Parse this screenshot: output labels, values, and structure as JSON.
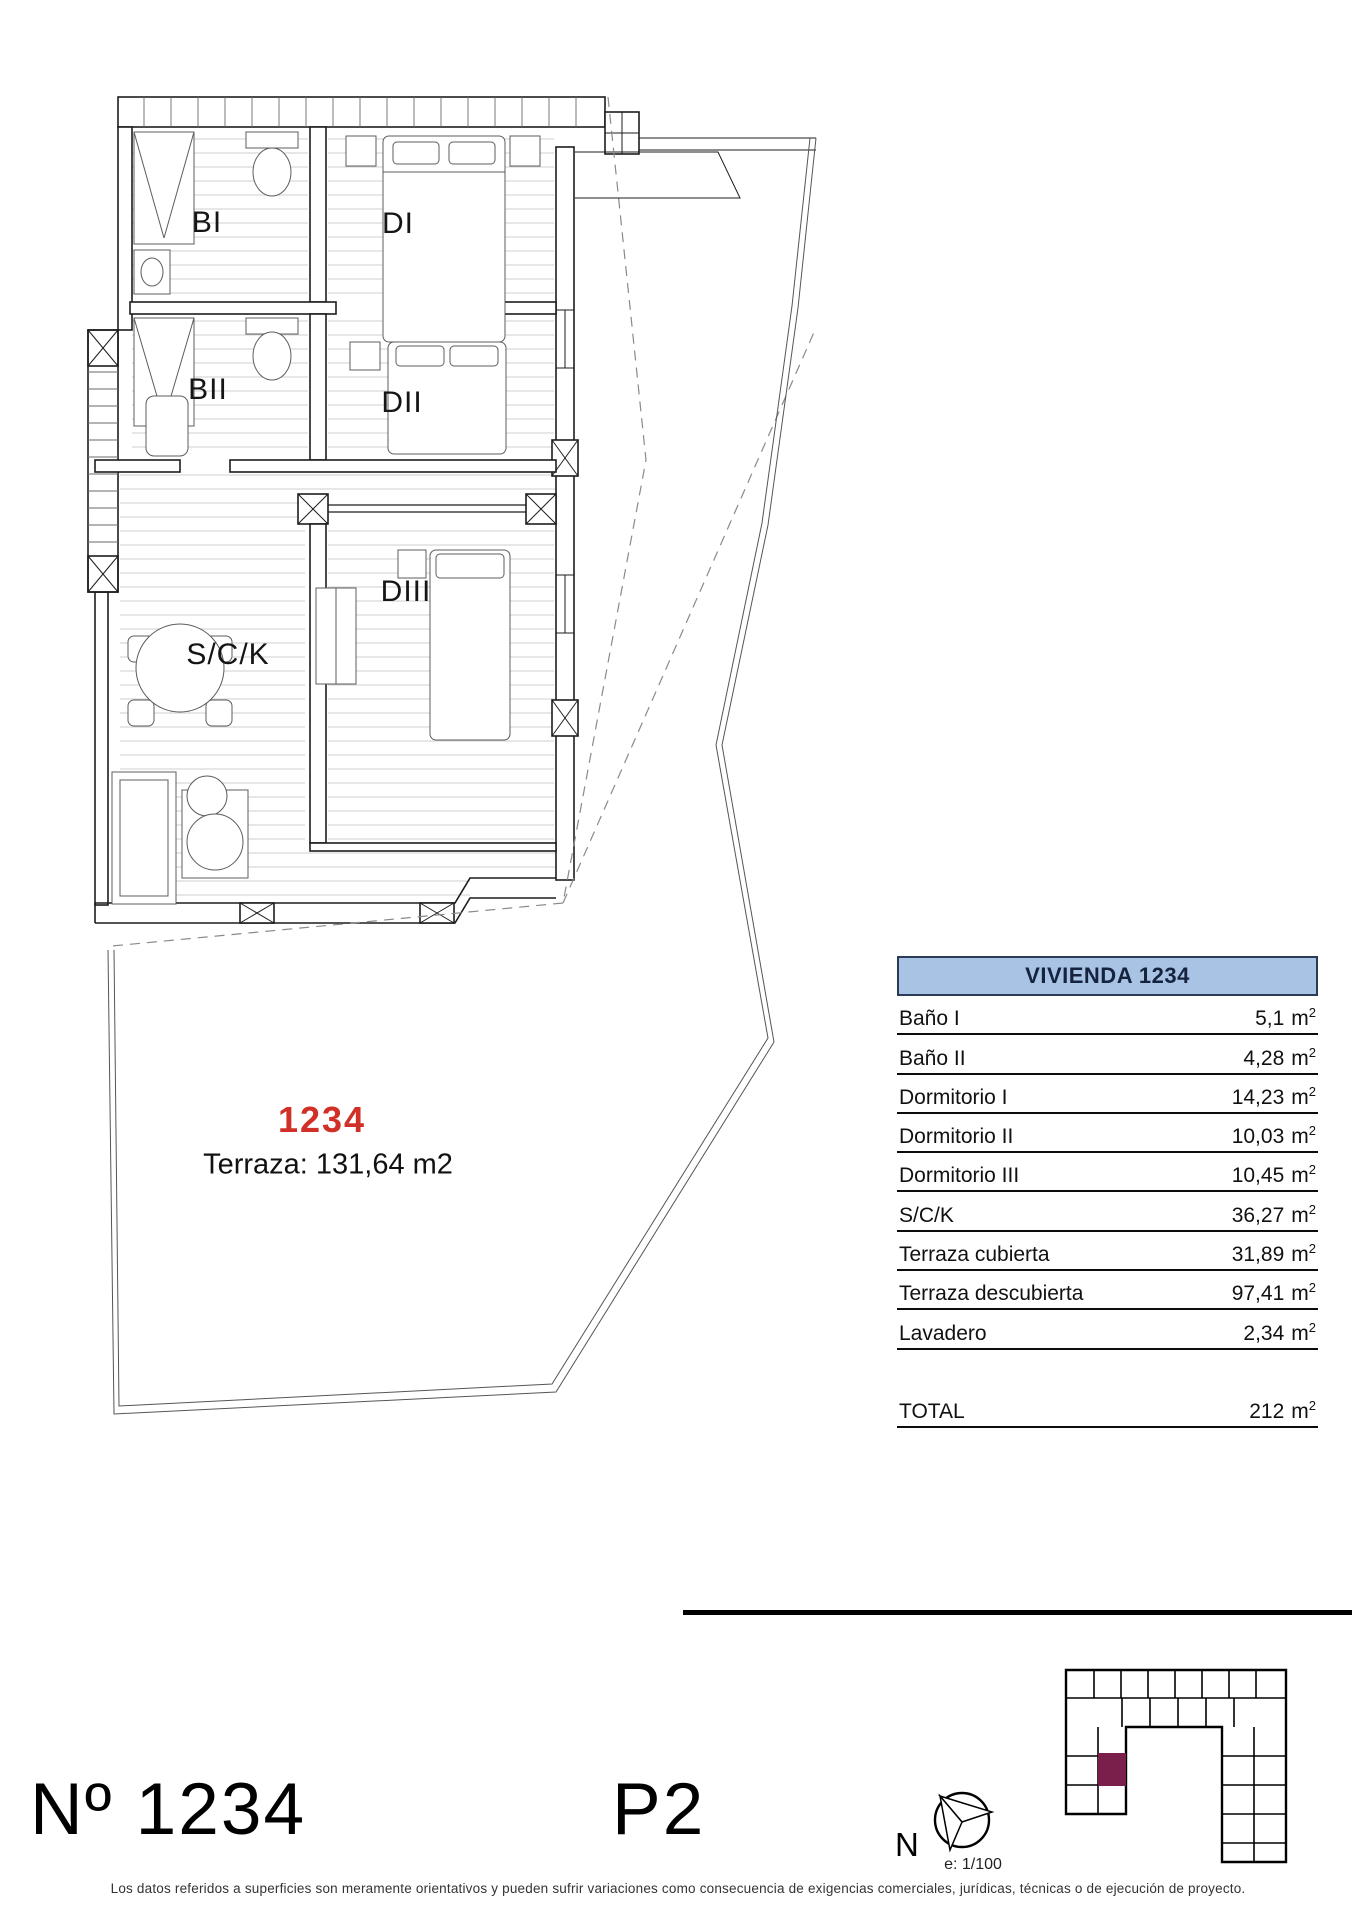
{
  "unit": {
    "number_red": "1234",
    "terrace_note": "Terraza: 131,64 m2",
    "sheet_title": "Nº 1234",
    "floor_label": "P2"
  },
  "rooms": {
    "bath1": "BI",
    "bed1": "DI",
    "bath2": "BII",
    "bed2": "DII",
    "bed3": "DIII",
    "living_kitchen": "S/C/K"
  },
  "table": {
    "header": "VIVIENDA 1234",
    "unit_m": "m",
    "unit_sup": "2",
    "rows": [
      {
        "label": "Baño I",
        "value": "5,1"
      },
      {
        "label": "Baño II",
        "value": "4,28"
      },
      {
        "label": "Dormitorio I",
        "value": "14,23"
      },
      {
        "label": "Dormitorio II",
        "value": "10,03"
      },
      {
        "label": "Dormitorio III",
        "value": "10,45"
      },
      {
        "label": "S/C/K",
        "value": "36,27"
      },
      {
        "label": "Terraza cubierta",
        "value": "31,89"
      },
      {
        "label": "Terraza descubierta",
        "value": "97,41"
      },
      {
        "label": "Lavadero",
        "value": "2,34"
      }
    ],
    "total": {
      "label": "TOTAL",
      "value": "212"
    }
  },
  "compass": {
    "north": "N",
    "scale": "e: 1/100"
  },
  "footer": {
    "disclaimer": "Los datos referidos a superficies son meramente orientativos y pueden sufrir variaciones como consecuencia de exigencias comerciales, jurídicas, técnicas o de ejecución de proyecto."
  },
  "colors": {
    "accent_red": "#d03027",
    "site_highlight": "#7a1f4b",
    "table_header_bg": "#a9c3e4",
    "table_header_border": "#2a3c55"
  }
}
